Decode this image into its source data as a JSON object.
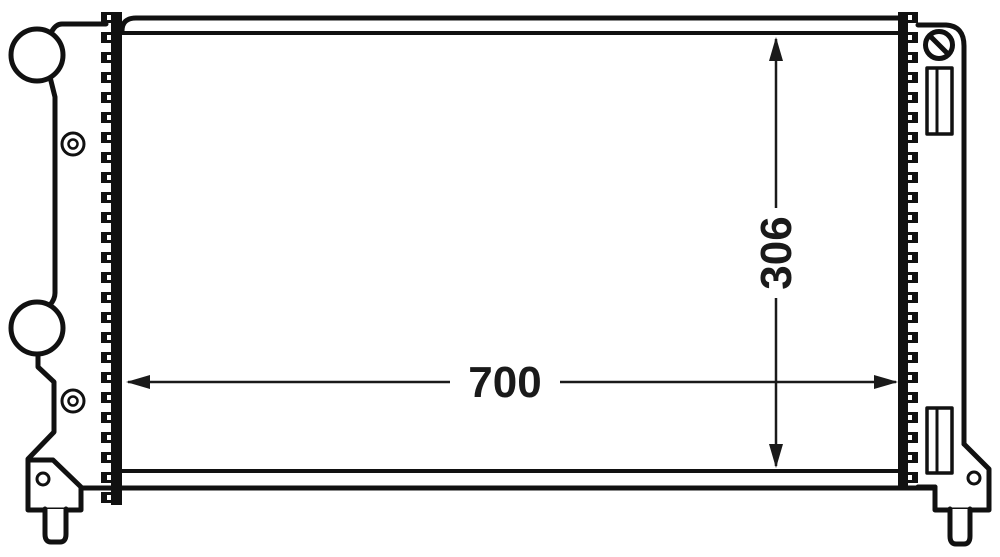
{
  "drawing": {
    "kind": "radiator-dimension-drawing",
    "width_dimension": {
      "label": "700"
    },
    "height_dimension": {
      "label": "306"
    }
  },
  "colors": {
    "line": "#111111",
    "background": "#ffffff",
    "dimension": "#1a1a1a"
  }
}
